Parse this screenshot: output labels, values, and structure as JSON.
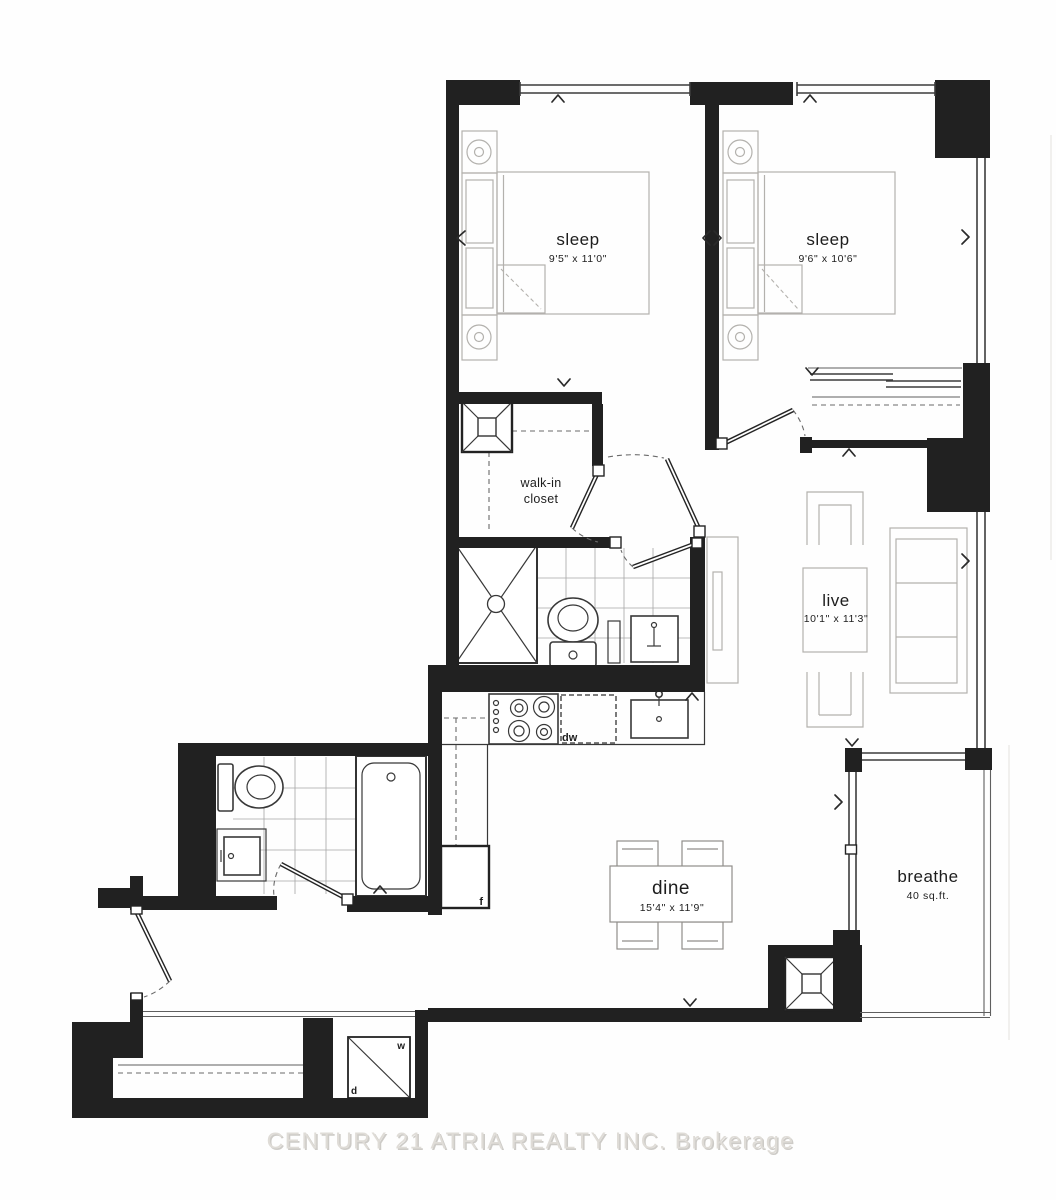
{
  "plan": {
    "watermark": "CENTURY 21 ATRIA REALTY INC. Brokerage",
    "rooms": {
      "bedroom1": {
        "label": "sleep",
        "dims": "9'5\" x 11'0\""
      },
      "bedroom2": {
        "label": "sleep",
        "dims": "9'6\" x 10'6\""
      },
      "living": {
        "label": "live",
        "dims": "10'1\" x 11'3\""
      },
      "dining": {
        "label": "dine",
        "dims": "15'4\" x 11'9\""
      },
      "balcony": {
        "label": "breathe",
        "area": "40 sq.ft."
      },
      "walkin_closet": {
        "line1": "walk-in",
        "line2": "closet"
      }
    },
    "appliances": {
      "dishwasher": "dw",
      "fridge": "f",
      "washer": "w",
      "dryer": "d"
    },
    "colors": {
      "wall": "#212121",
      "fixture_line": "#383838",
      "furniture_line": "#b3b1ad",
      "tile_line": "#a6a6a6",
      "label_text": "#1d1d1d",
      "watermark": "#dfdcd7"
    }
  }
}
